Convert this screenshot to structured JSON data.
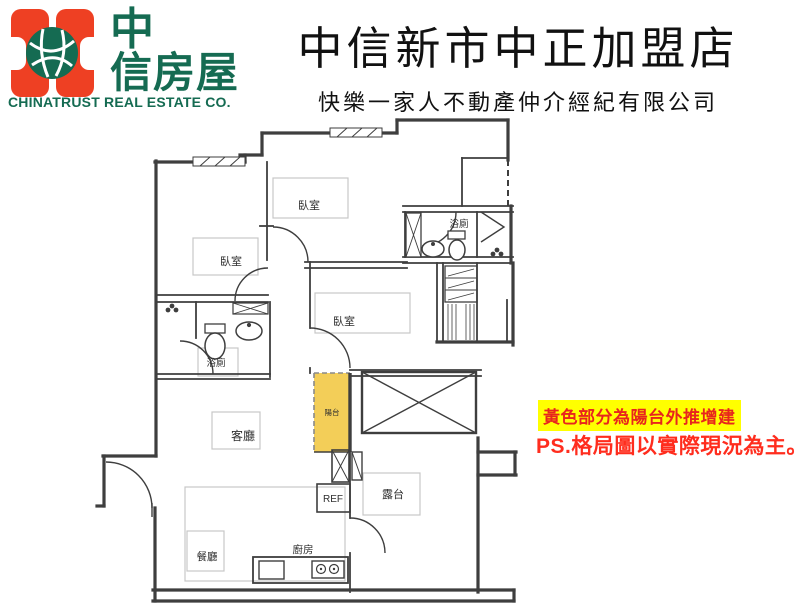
{
  "header": {
    "logo": {
      "brand_line1": "中",
      "brand_line2": "信房屋",
      "english": "CHINATRUST REAL ESTATE CO.",
      "orange": "#EE4023",
      "green": "#156B52"
    },
    "title": "中信新市中正加盟店",
    "subtitle": "快樂一家人不動產仲介經紀有限公司"
  },
  "floorplan": {
    "rooms": {
      "bedroom_top": "臥室",
      "bedroom_left": "臥室",
      "bedroom_mid": "臥室",
      "bath_right": "浴廁",
      "bath_left": "浴廁",
      "living": "客廳",
      "balcony": "陽台",
      "terrace": "露台",
      "dining": "餐廳",
      "kitchen": "廚房",
      "fridge": "REF"
    },
    "highlight_color": "#F3CE58",
    "line_color": "#3E3E3E"
  },
  "notes": {
    "highlight_note": "黃色部分為陽台外推增建",
    "ps_note": "PS.格局圖以實際現況為主。",
    "note_bg": "#FFFF00",
    "note_color": "#E8251D"
  }
}
